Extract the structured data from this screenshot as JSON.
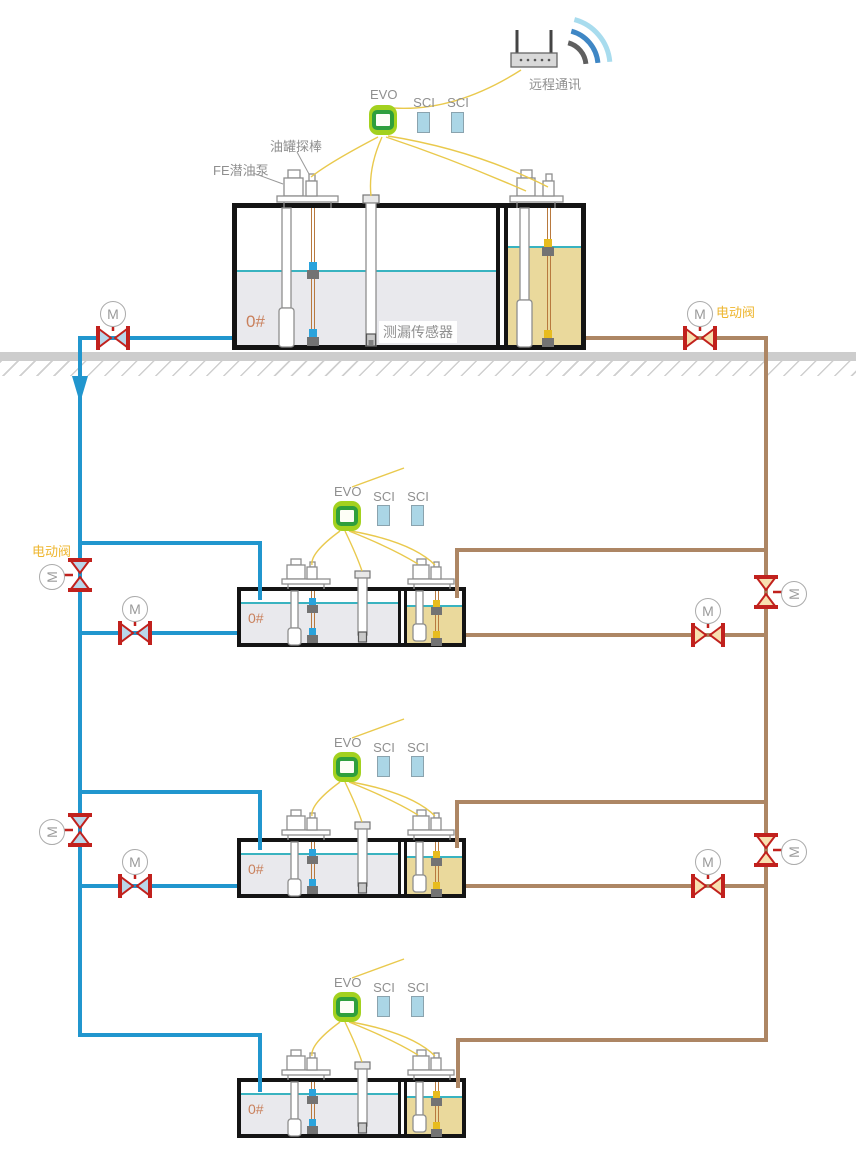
{
  "labels": {
    "evo": "EVO",
    "sci": "SCI",
    "motor": "M",
    "fuel_grade": "0#",
    "electric_valve": "电动阀",
    "remote_comm": "远程通讯",
    "tank_probe": "油罐探棒",
    "fe_pump": "FE潜油泵",
    "leak_sensor": "测漏传感器"
  },
  "colors": {
    "supply_pipe_blue": "#2196ce",
    "return_pipe_brown": "#ad8664",
    "wire_yellow": "#e9c94d",
    "valve_red": "#c1211d",
    "valve_fill_blue": "#b9d7ea",
    "valve_fill_tan": "#f8e0b0",
    "evo_green": "#a3d11f",
    "evo_core_green": "#2f9f3c",
    "sci_blue": "#abd6e6",
    "liquid_gray": "#e9e9ed",
    "liquid_tan": "#ead99c",
    "level_teal": "#39b3c0",
    "label_gray": "#8f8f8f",
    "label_orange": "#eeb62f",
    "grade_label_color": "#c9805c",
    "ground_gray": "#cdcdcd"
  }
}
